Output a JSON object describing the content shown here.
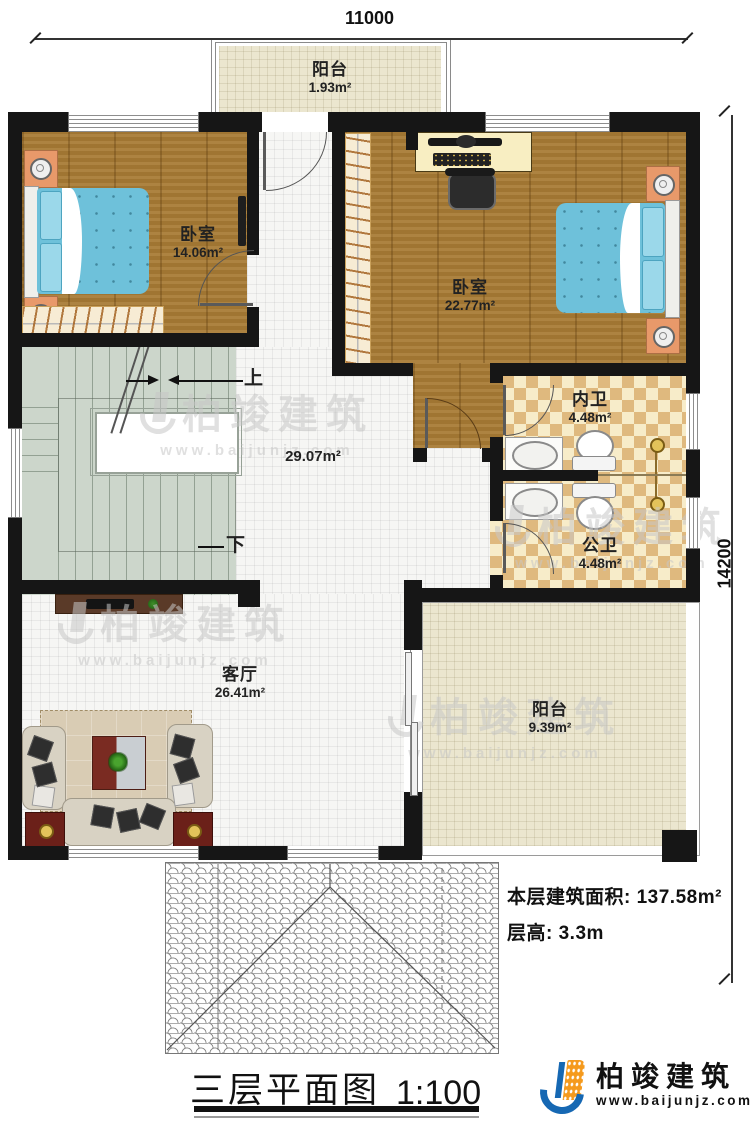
{
  "dimensions": {
    "width_mm": "11000",
    "height_mm": "14200"
  },
  "rooms": {
    "balcony_top": {
      "name": "阳台",
      "area": "1.93m²"
    },
    "bedroom_left": {
      "name": "卧室",
      "area": "14.06m²"
    },
    "bedroom_right": {
      "name": "卧室",
      "area": "22.77m²"
    },
    "bath_inner": {
      "name": "内卫",
      "area": "4.48m²"
    },
    "bath_public": {
      "name": "公卫",
      "area": "4.48m²"
    },
    "hallway": {
      "area": "29.07m²"
    },
    "living_room": {
      "name": "客厅",
      "area": "26.41m²"
    },
    "balcony_bottom": {
      "name": "阳台",
      "area": "9.39m²"
    }
  },
  "stairs": {
    "up_label": "上",
    "down_label": "下"
  },
  "notes": {
    "floor_area": "本层建筑面积: 137.58m²",
    "floor_height": "层高: 3.3m"
  },
  "title_block": {
    "title": "三层平面图",
    "scale": "1:100"
  },
  "branding": {
    "company": "柏竣建筑",
    "website": "www.baijunjz.com"
  },
  "watermark": {
    "company": "柏竣建筑",
    "website": "www.baijunjz.com"
  },
  "colors": {
    "wall": "#161616",
    "wood_floor": "#a87b35",
    "tile_floor": "#f6f6f4",
    "stair_floor": "#ccd6cb",
    "bath_tile_dark": "#dfb97e",
    "bath_tile_light": "#f7ecc9",
    "balcony_floor": "#ebe6cf",
    "bed": "#6ec1da",
    "logo_blue": "#1668b3",
    "logo_orange": "#f59a1d"
  }
}
